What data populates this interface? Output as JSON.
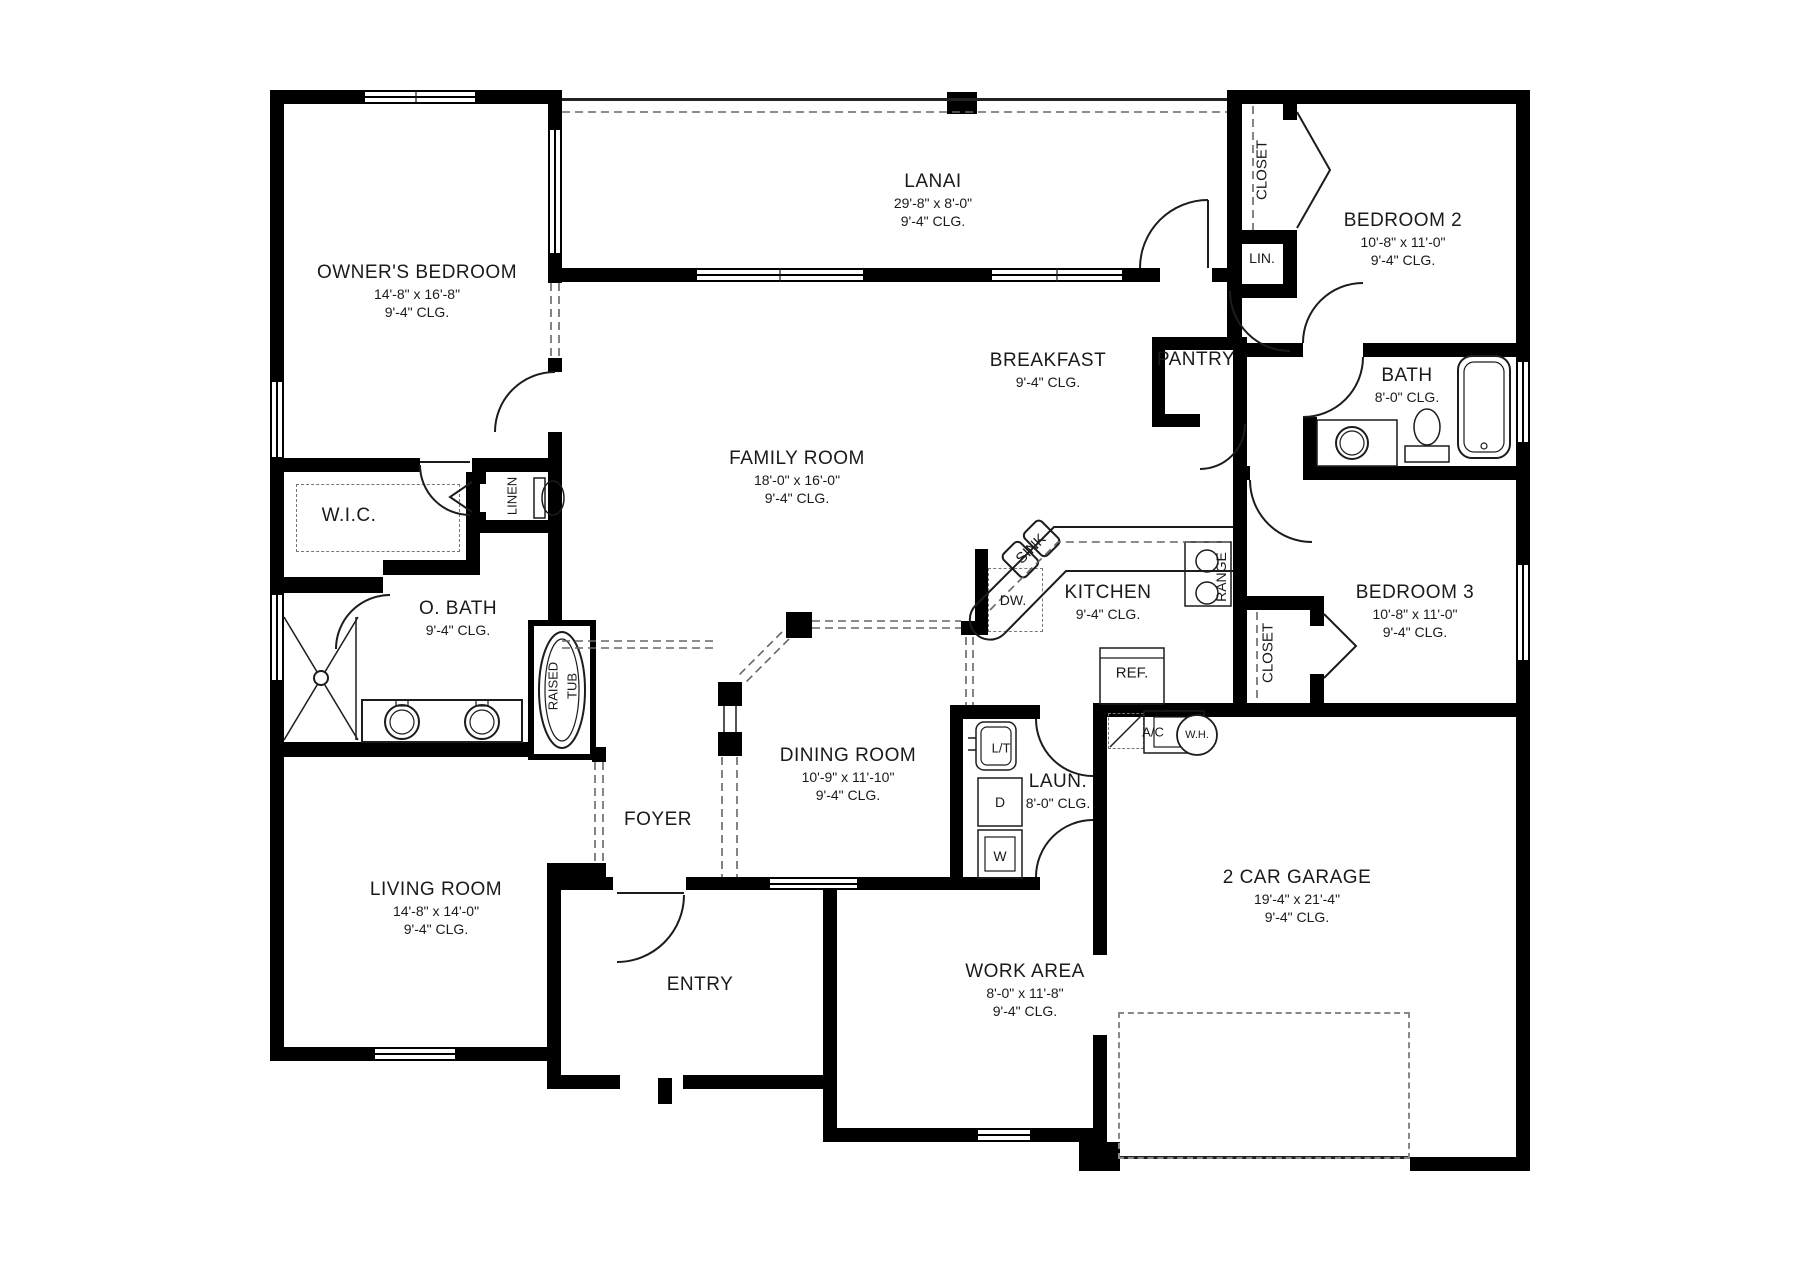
{
  "title": "Single-story house floor plan",
  "colors": {
    "wall": "#000000",
    "line": "#1c1c1c",
    "dashed": "#777777",
    "background": "#ffffff",
    "text": "#1a1a1a"
  },
  "rooms": [
    {
      "id": "owners-bedroom",
      "name": "OWNER'S BEDROOM",
      "lines": [
        "14'-8\" x 16'-8\"",
        "9'-4\" CLG."
      ],
      "x": 417,
      "y": 291,
      "rot": 0
    },
    {
      "id": "lanai",
      "name": "LANAI",
      "lines": [
        "29'-8\" x 8'-0\"",
        "9'-4\" CLG."
      ],
      "x": 933,
      "y": 200,
      "rot": 0
    },
    {
      "id": "bedroom-2",
      "name": "BEDROOM 2",
      "lines": [
        "10'-8\" x 11'-0\"",
        "9'-4\" CLG."
      ],
      "x": 1403,
      "y": 239,
      "rot": 0
    },
    {
      "id": "bath",
      "name": "BATH",
      "lines": [
        "8'-0\" CLG."
      ],
      "x": 1407,
      "y": 385,
      "rot": 0
    },
    {
      "id": "family-room",
      "name": "FAMILY ROOM",
      "lines": [
        "18'-0\" x 16'-0\"",
        "9'-4\" CLG."
      ],
      "x": 797,
      "y": 477,
      "rot": 0
    },
    {
      "id": "breakfast",
      "name": "BREAKFAST",
      "lines": [
        "9'-4\" CLG."
      ],
      "x": 1048,
      "y": 370,
      "rot": 0
    },
    {
      "id": "pantry",
      "name": "PANTRY",
      "lines": [],
      "x": 1196,
      "y": 360,
      "rot": 0
    },
    {
      "id": "bedroom-3",
      "name": "BEDROOM 3",
      "lines": [
        "10'-8\" x 11'-0\"",
        "9'-4\" CLG."
      ],
      "x": 1415,
      "y": 611,
      "rot": 0
    },
    {
      "id": "kitchen",
      "name": "KITCHEN",
      "lines": [
        "9'-4\" CLG."
      ],
      "x": 1108,
      "y": 602,
      "rot": 0
    },
    {
      "id": "wic",
      "name": "W.I.C.",
      "lines": [],
      "x": 349,
      "y": 516,
      "rot": 0
    },
    {
      "id": "o-bath",
      "name": "O. BATH",
      "lines": [
        "9'-4\" CLG."
      ],
      "x": 458,
      "y": 618,
      "rot": 0
    },
    {
      "id": "dining-room",
      "name": "DINING ROOM",
      "lines": [
        "10'-9\" x 11'-10\"",
        "9'-4\" CLG."
      ],
      "x": 848,
      "y": 774,
      "rot": 0
    },
    {
      "id": "laundry",
      "name": "LAUN.",
      "lines": [
        "8'-0\" CLG."
      ],
      "x": 1058,
      "y": 791,
      "rot": 0
    },
    {
      "id": "foyer",
      "name": "FOYER",
      "lines": [],
      "x": 658,
      "y": 820,
      "rot": 0
    },
    {
      "id": "entry",
      "name": "ENTRY",
      "lines": [],
      "x": 700,
      "y": 985,
      "rot": 0
    },
    {
      "id": "living-room",
      "name": "LIVING ROOM",
      "lines": [
        "14'-8\" x 14'-0\"",
        "9'-4\" CLG."
      ],
      "x": 436,
      "y": 908,
      "rot": 0
    },
    {
      "id": "garage",
      "name": "2 CAR GARAGE",
      "lines": [
        "19'-4\" x 21'-4\"",
        "9'-4\" CLG."
      ],
      "x": 1297,
      "y": 896,
      "rot": 0
    },
    {
      "id": "work-area",
      "name": "WORK AREA",
      "lines": [
        "8'-0\" x 11'-8\"",
        "9'-4\" CLG."
      ],
      "x": 1025,
      "y": 990,
      "rot": 0
    }
  ],
  "fixture_labels": [
    {
      "id": "closet-bedroom2",
      "t": "CLOSET",
      "x": 1262,
      "y": 170,
      "rot": -90,
      "size": 15
    },
    {
      "id": "linen-closet-hall",
      "t": "LIN.",
      "x": 1262,
      "y": 258,
      "rot": 0,
      "size": 14
    },
    {
      "id": "closet-bedroom3",
      "t": "CLOSET",
      "x": 1268,
      "y": 653,
      "rot": -90,
      "size": 15
    },
    {
      "id": "range",
      "t": "RANGE",
      "x": 1221,
      "y": 577,
      "rot": -90,
      "size": 14
    },
    {
      "id": "refrigerator",
      "t": "REF.",
      "x": 1132,
      "y": 673,
      "rot": 0,
      "size": 15
    },
    {
      "id": "dishwasher",
      "t": "DW.",
      "x": 1013,
      "y": 600,
      "rot": 0,
      "size": 14
    },
    {
      "id": "kitchen-sink",
      "t": "SINK",
      "x": 1031,
      "y": 549,
      "rot": -45,
      "size": 15
    },
    {
      "id": "ac-unit",
      "t": "A/C",
      "x": 1153,
      "y": 732,
      "rot": 0,
      "size": 13
    },
    {
      "id": "water-heater",
      "t": "W.H.",
      "x": 1197,
      "y": 735,
      "rot": 0,
      "size": 11
    },
    {
      "id": "laundry-tub",
      "t": "L/T",
      "x": 1001,
      "y": 748,
      "rot": 0,
      "size": 13
    },
    {
      "id": "dryer",
      "t": "D",
      "x": 1000,
      "y": 802,
      "rot": 0,
      "size": 14
    },
    {
      "id": "washer",
      "t": "W",
      "x": 1000,
      "y": 856,
      "rot": 0,
      "size": 14
    },
    {
      "id": "linen-obath",
      "t": "LINEN",
      "x": 512,
      "y": 496,
      "rot": -90,
      "size": 13
    },
    {
      "id": "raised-tub-1",
      "t": "RAISED",
      "x": 553,
      "y": 686,
      "rot": -90,
      "size": 13
    },
    {
      "id": "raised-tub-2",
      "t": "TUB",
      "x": 572,
      "y": 686,
      "rot": -90,
      "size": 13
    }
  ]
}
